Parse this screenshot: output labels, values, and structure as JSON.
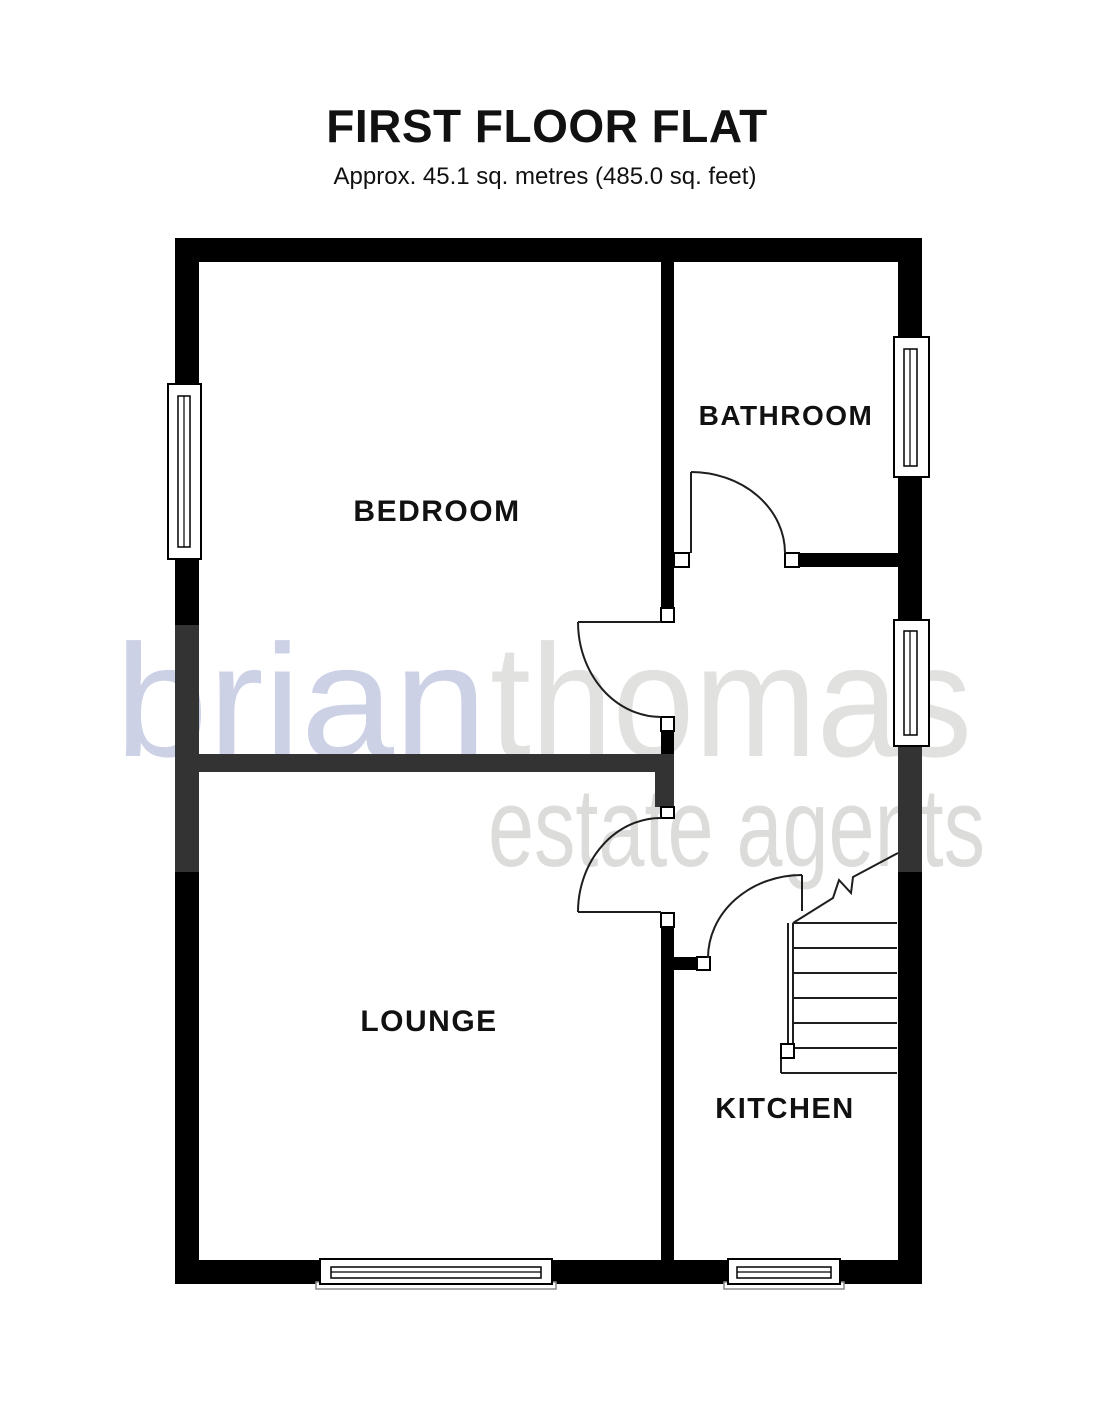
{
  "title": {
    "text": "FIRST FLOOR FLAT",
    "subtitle": "Approx. 45.1 sq. metres (485.0 sq. feet)"
  },
  "plan": {
    "rooms": {
      "bedroom": "BEDROOM",
      "bathroom": "BATHROOM",
      "lounge": "LOUNGE",
      "kitchen": "KITCHEN"
    }
  },
  "watermark": {
    "brand_first": "brian",
    "brand_second": "thomas",
    "tagline": "estate agents",
    "accent_color": "#ccd1e5",
    "gray_color": "#e1e1df",
    "tagline_color": "#dcdcda"
  },
  "colors": {
    "wall": "#000000",
    "shared_wall": "#333333",
    "label": "#111111"
  }
}
